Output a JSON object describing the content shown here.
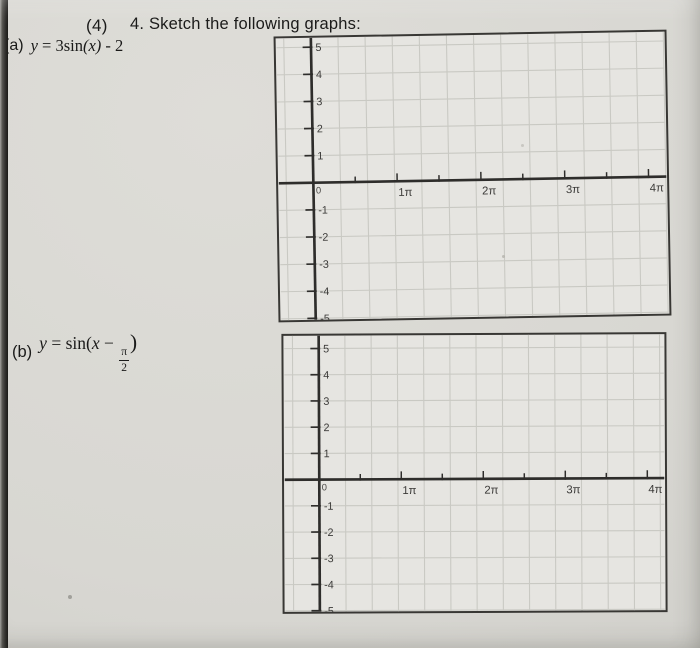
{
  "header": {
    "points_label": "(4)",
    "title": "4. Sketch the following graphs:"
  },
  "parts": {
    "a": {
      "label": "(a)",
      "segments": [
        {
          "t": "y",
          "st": "it"
        },
        {
          "t": " = 3sin",
          "st": "rm"
        },
        {
          "t": "(x)",
          "st": "it"
        },
        {
          "t": " - 2",
          "st": "rm"
        }
      ]
    },
    "b": {
      "label": "(b)",
      "segments": [
        {
          "t": "y",
          "st": "it"
        },
        {
          "t": " = sin(",
          "st": "rm"
        },
        {
          "t": "x",
          "st": "it"
        },
        {
          "t": " − ",
          "st": "rm"
        },
        {
          "st": "frac",
          "n": "π",
          "d": "2"
        },
        {
          "t": ")",
          "st": "paren"
        }
      ]
    }
  },
  "graph_axes": {
    "y_ticks_positive": [
      "5",
      "4",
      "3",
      "2",
      "1"
    ],
    "origin": "0",
    "y_ticks_negative": [
      "-1",
      "-2",
      "-3",
      "-4",
      "-5"
    ],
    "x_ticks": [
      "1π",
      "2π",
      "3π",
      "4π"
    ]
  },
  "colors": {
    "paper": "#d8d7d2",
    "graph_paper": "#e6e5e1",
    "grid_line": "#c9c9c3",
    "axis": "#2e2d2b",
    "tick_label": "#3b3a38",
    "text": "#1a1a19",
    "edge_dark": "#1b1a17"
  }
}
